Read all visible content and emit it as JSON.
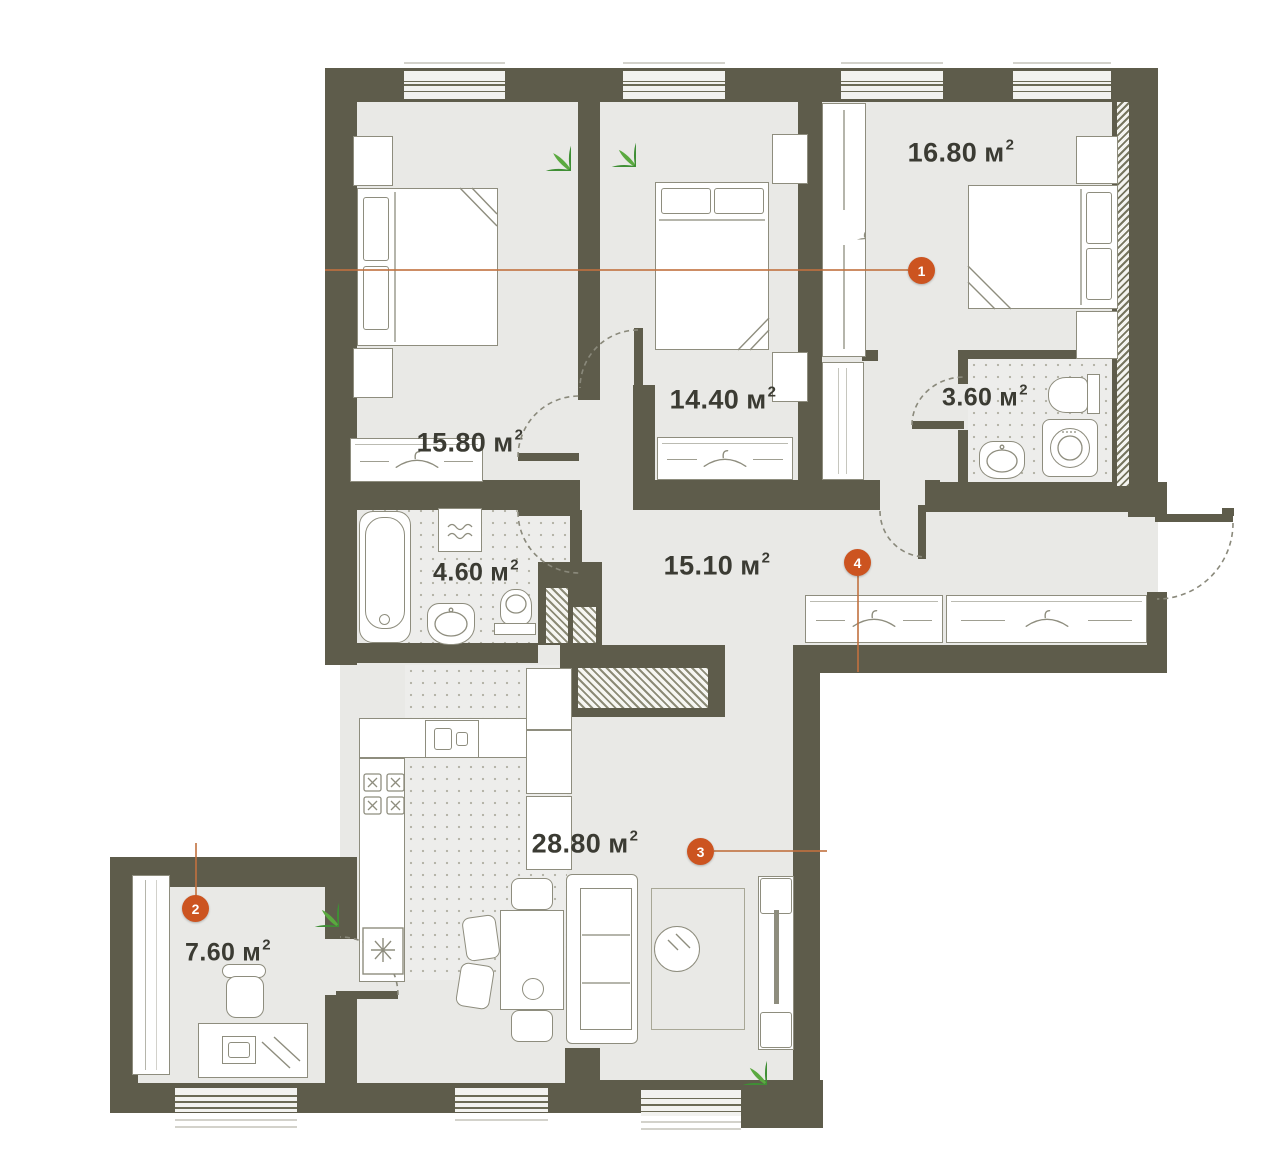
{
  "units": {
    "base": "м",
    "sup": "2"
  },
  "rooms": {
    "bedroom_a": {
      "area": "15.80"
    },
    "bedroom_b": {
      "area": "14.40"
    },
    "bedroom_c": {
      "area": "16.80"
    },
    "bathroom_small": {
      "area": "3.60"
    },
    "bathroom_main": {
      "area": "4.60"
    },
    "hallway": {
      "area": "15.10"
    },
    "living_kitchen": {
      "area": "28.80"
    },
    "office": {
      "area": "7.60"
    }
  },
  "markers": {
    "m1": {
      "number": "1"
    },
    "m2": {
      "number": "2"
    },
    "m3": {
      "number": "3"
    },
    "m4": {
      "number": "4"
    }
  },
  "colors": {
    "wall": "#5e5c4b",
    "floor": "#e9e9e6",
    "accent": "#cc5420",
    "line": "#8e8d7e",
    "text": "#3b3b33",
    "dots": "#b6b5a9",
    "plant1": "#3f8f35",
    "plant2": "#5aa93f"
  }
}
